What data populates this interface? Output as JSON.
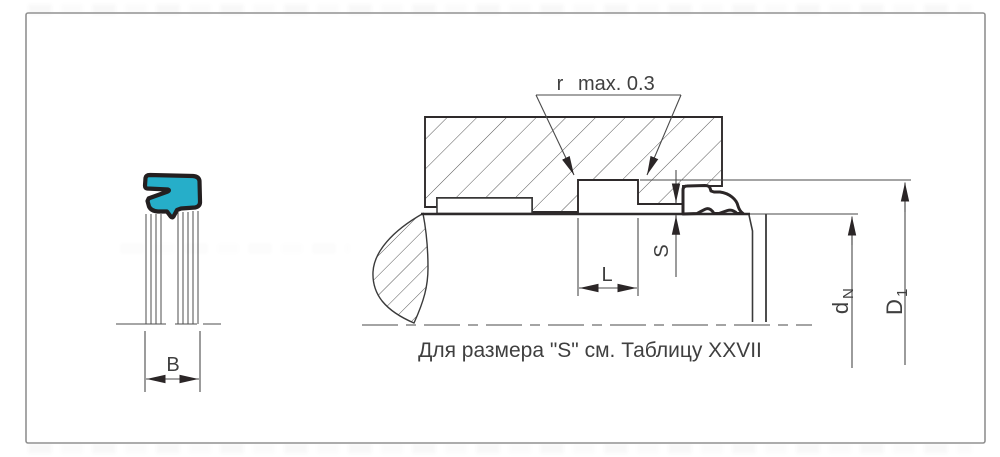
{
  "diagram": {
    "type": "technical-drawing",
    "labels": {
      "radius_prefix": "r",
      "radius_value": "max. 0.3",
      "groove_length": "L",
      "gap": "S",
      "seal_width": "B",
      "rod_diameter_main": "d",
      "rod_diameter_sub": "N",
      "groove_diameter_main": "D",
      "groove_diameter_sub": "1",
      "note": "Для размера \"S\" см. Таблицу XXVII"
    },
    "colors": {
      "seal_fill": "#26aec9",
      "seal_outline": "#231f20",
      "line_color": "#4a4a4a",
      "frame_color": "#919191"
    }
  }
}
